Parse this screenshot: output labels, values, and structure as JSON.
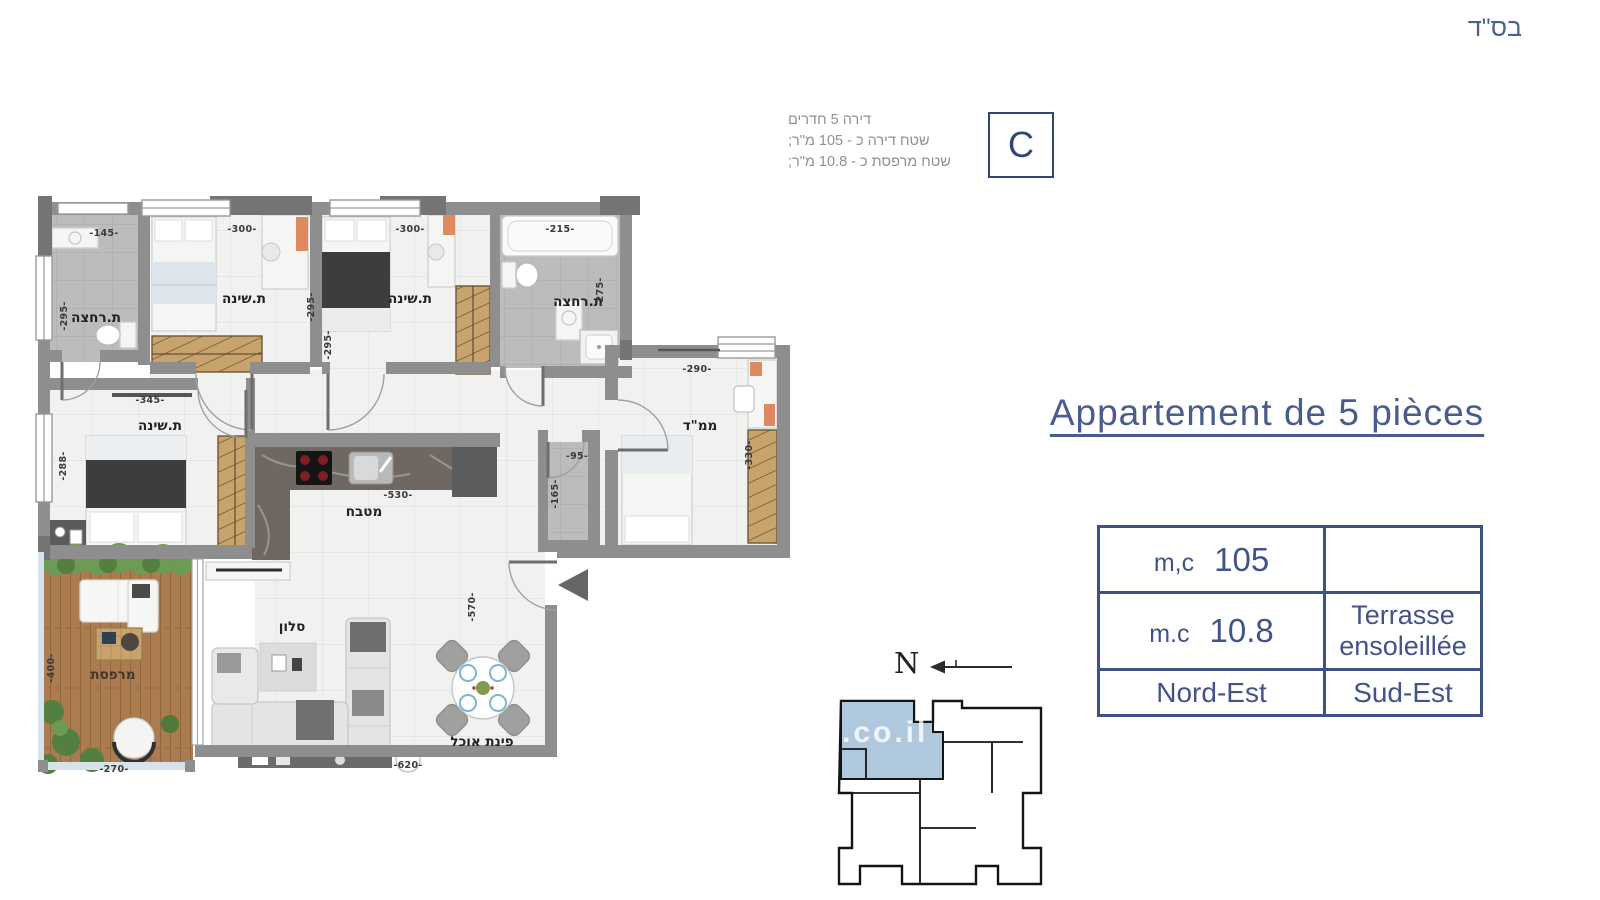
{
  "page": {
    "bsd": "בס\"ד"
  },
  "unit_info": {
    "line1": "דירה 5 חדרים",
    "line2": "שטח דירה כ - 105 מ\"ר;",
    "line3": "שטח מרפסת כ - 10.8 מ\"ר;",
    "unit_letter": "C"
  },
  "title": {
    "text": "Appartement de 5 pièces"
  },
  "details_table": {
    "r1c1_label": "m,c",
    "r1c1_value": "105",
    "r1c2": "",
    "r2c1_label": "m.c",
    "r2c1_value": "10.8",
    "r2c2_line1": "Terrasse",
    "r2c2_line2": "ensoleillée",
    "r3c1": "Nord-Est",
    "r3c2": "Sud-Est"
  },
  "compass": {
    "label": "N"
  },
  "keyplan": {
    "watermark": ".co.il",
    "highlight_color": "#b0c8de"
  },
  "floorplan": {
    "rooms": {
      "bath_top_left": "ת.רחצה",
      "bedroom_1": "ת.שינה",
      "bedroom_2": "ת.שינה",
      "bath_top_right": "ת.רחצה",
      "mamad": "ממ\"ד",
      "bedroom_3": "ת.שינה",
      "kitchen": "מטבח",
      "living": "סלון",
      "dining": "פינת אוכל",
      "terrace": "מרפסת"
    },
    "dims": {
      "d145": "-145-",
      "d295a": "-295-",
      "d300a": "-300-",
      "d295b": "-295-",
      "d300b": "-300-",
      "d295c": "-295-",
      "d215": "-215-",
      "d275": "-275-",
      "d290": "-290-",
      "d330": "-330-",
      "d345": "-345-",
      "d288": "-288-",
      "d530": "-530-",
      "d95": "-95-",
      "d165": "-165-",
      "d570": "-570-",
      "d620": "-620-",
      "d400": "-400-",
      "d270": "-270-"
    }
  },
  "colors": {
    "accent": "#3e5184",
    "wall": "#8e8e8e"
  }
}
